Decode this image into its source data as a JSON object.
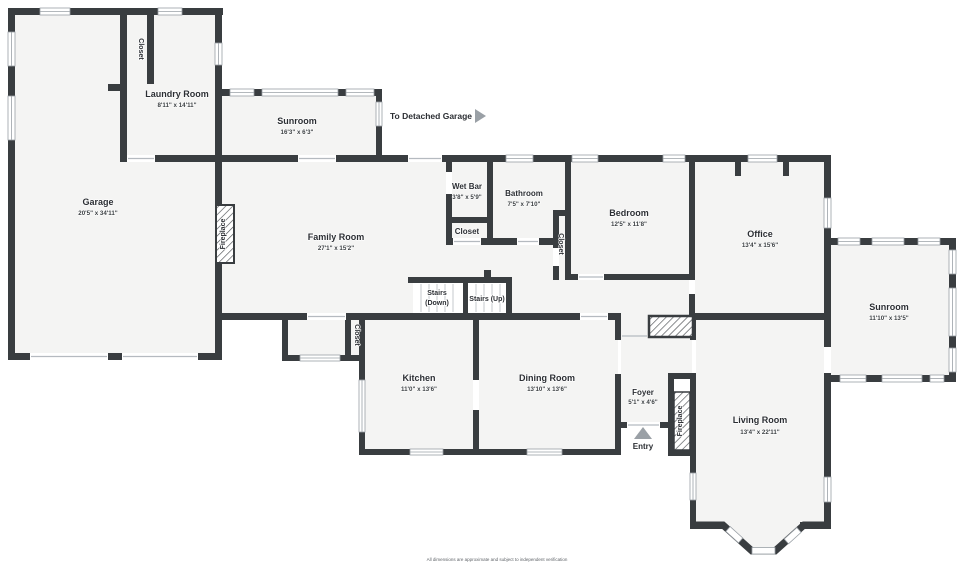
{
  "meta": {
    "disclaimer": "All dimensions are approximate and subject to independent verification"
  },
  "annotations": {
    "to_detached_garage": "To Detached Garage",
    "entry": "Entry"
  },
  "rooms": {
    "garage": {
      "name": "Garage",
      "dims": "20'5\" x 34'11\""
    },
    "laundry": {
      "name": "Laundry Room",
      "dims": "8'11\" x 14'11\""
    },
    "sunroom_top": {
      "name": "Sunroom",
      "dims": "16'3\" x 6'3\""
    },
    "family_room": {
      "name": "Family Room",
      "dims": "27'1\" x 15'2\""
    },
    "wet_bar": {
      "name": "Wet Bar",
      "dims": "3'8\" x 5'9\""
    },
    "bathroom": {
      "name": "Bathroom",
      "dims": "7'5\" x 7'10\""
    },
    "bedroom": {
      "name": "Bedroom",
      "dims": "12'5\" x 11'8\""
    },
    "office": {
      "name": "Office",
      "dims": "13'4\" x 15'6\""
    },
    "sunroom_right": {
      "name": "Sunroom",
      "dims": "11'10\" x 13'5\""
    },
    "kitchen": {
      "name": "Kitchen",
      "dims": "11'0\" x 13'6\""
    },
    "dining_room": {
      "name": "Dining Room",
      "dims": "13'10\" x 13'6\""
    },
    "foyer": {
      "name": "Foyer",
      "dims": "5'1\" x 4'6\""
    },
    "living_room": {
      "name": "Living Room",
      "dims": "13'4\" x 22'11\""
    },
    "closet_laundry": {
      "name": "Closet"
    },
    "closet_wetbar": {
      "name": "Closet"
    },
    "closet_bedroom": {
      "name": "Closet"
    },
    "closet_kitchen": {
      "name": "Closet"
    },
    "fireplace_family": {
      "name": "Fireplace"
    },
    "fireplace_foyer": {
      "name": "Fireplace"
    },
    "stairs_down": {
      "line1": "Stairs",
      "line2": "(Down)"
    },
    "stairs_up": {
      "name": "Stairs (Up)"
    }
  },
  "colors": {
    "wall": "#393d40",
    "floor": "#f4f4f3",
    "window_frame": "#9aa0a6",
    "arrow_gray": "#9aa0a6",
    "background": "#ffffff"
  }
}
